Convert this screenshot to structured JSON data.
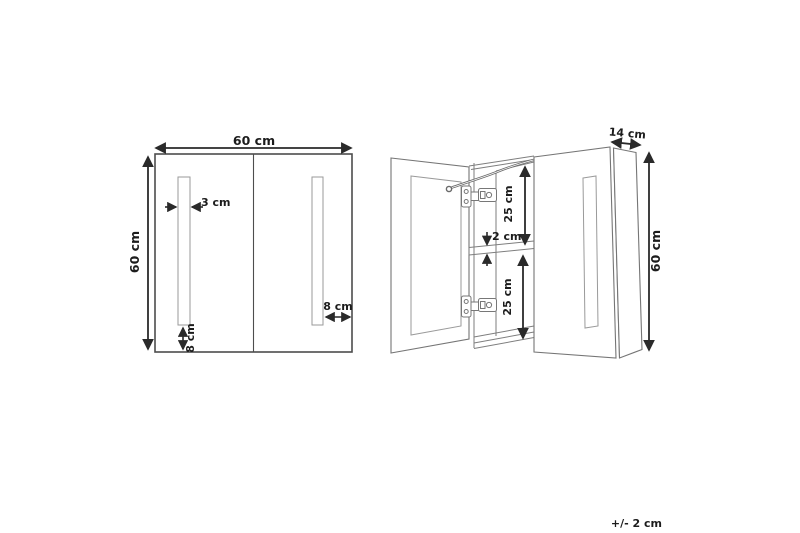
{
  "front_view": {
    "width_label": "60 cm",
    "height_label": "60 cm",
    "light_strip_width_label": "3 cm",
    "strip_bottom_gap_label": "8 cm",
    "strip_edge_gap_label": "8 cm"
  },
  "side_view": {
    "depth_label": "14 cm",
    "height_label": "60 cm",
    "top_compartment_label": "25 cm",
    "shelf_thickness_label": "2 cm",
    "bottom_compartment_label": "25 cm"
  },
  "footer": {
    "tolerance_label": "+/- 2 cm"
  },
  "colors": {
    "background": "#ffffff",
    "cabinet_line": "#757575",
    "front_line": "#4d4d4d",
    "dimension_line": "#2a2a2a",
    "text": "#1c1c1c"
  }
}
